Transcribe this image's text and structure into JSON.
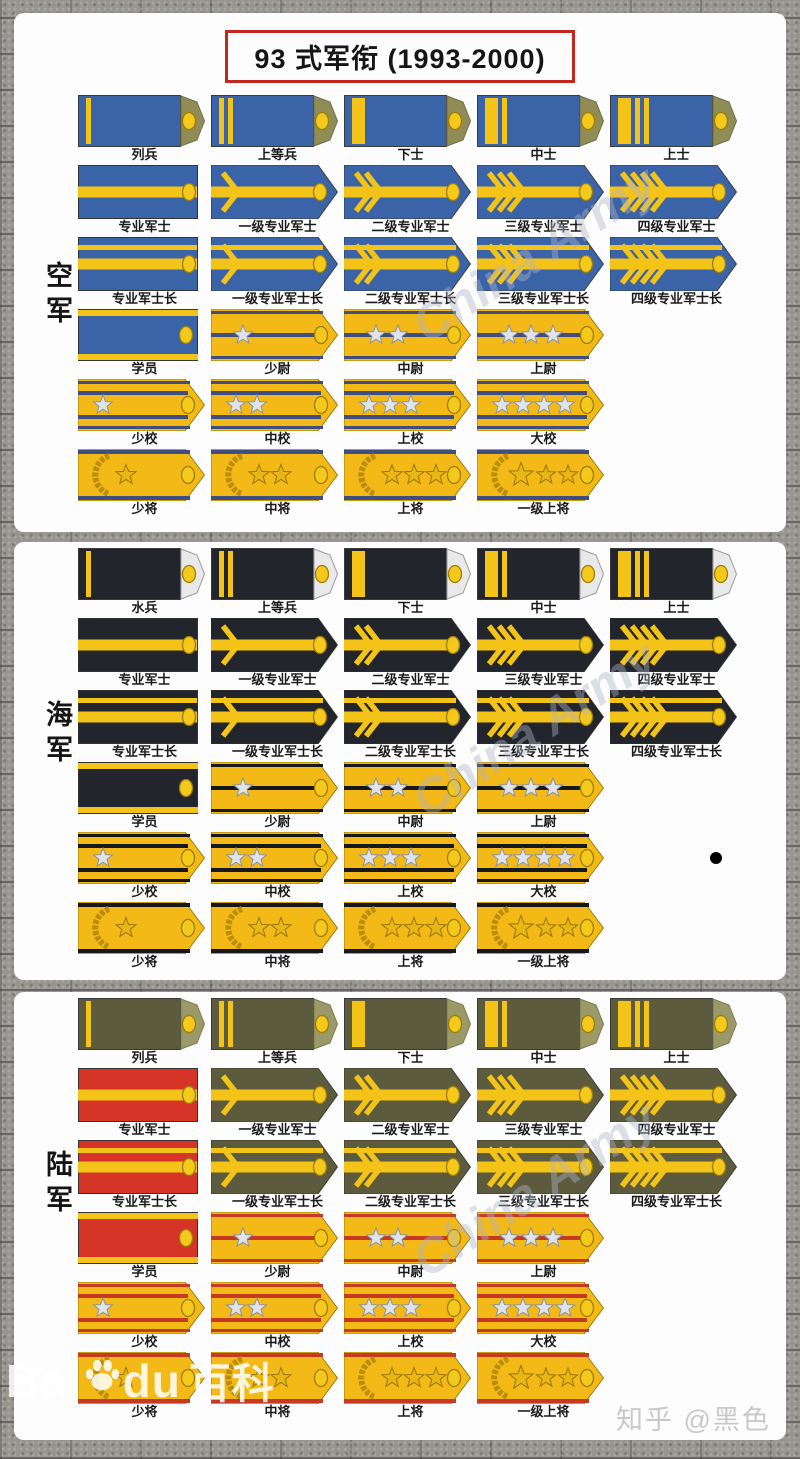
{
  "title": "93 式军衔 (1993-2000)",
  "watermark": {
    "diagonal": "China Army",
    "baidu_prefix": "Bai",
    "baidu_suffix": "du",
    "baidu_cn": "百科",
    "zhihu": "知乎 @黑色"
  },
  "colors": {
    "gold_board": "#f2b917",
    "gold_stripe": "#f3c318",
    "red_board": "#d63426",
    "silver_star": "#dfe3ea",
    "silver_star_edge": "#8d93a0",
    "general_star": "#e8b714",
    "general_star_edge": "#9a7506",
    "button": "#f4c91c",
    "button_edge": "#9c7d08",
    "wreath": "#bb8d0a",
    "title_border": "#c4271f"
  },
  "sections": [
    {
      "id": "af",
      "label": "空军",
      "scheme": {
        "board": "#3b63a8",
        "tip": "#8f8d55",
        "tip_edge": "#70704a",
        "officer_stripe": "#3f4e7e"
      },
      "rows": [
        {
          "type": "enlisted",
          "items": [
            {
              "label": "列兵",
              "stripes": [
                "thin"
              ]
            },
            {
              "label": "上等兵",
              "stripes": [
                "thin",
                "thin"
              ]
            },
            {
              "label": "下士",
              "stripes": [
                "wide"
              ]
            },
            {
              "label": "中士",
              "stripes": [
                "wide",
                "thin"
              ]
            },
            {
              "label": "上士",
              "stripes": [
                "wide",
                "thin",
                "thin"
              ]
            }
          ]
        },
        {
          "type": "sergeant",
          "bars": 1,
          "items": [
            {
              "label": "专业军士",
              "chevrons": 0,
              "shape": "rect"
            },
            {
              "label": "一级专业军士",
              "chevrons": 1
            },
            {
              "label": "二级专业军士",
              "chevrons": 2
            },
            {
              "label": "三级专业军士",
              "chevrons": 3
            },
            {
              "label": "四级专业军士",
              "chevrons": 4
            }
          ]
        },
        {
          "type": "sergeant",
          "bars": 2,
          "items": [
            {
              "label": "专业军士长",
              "chevrons": 0,
              "shape": "rect"
            },
            {
              "label": "一级专业军士长",
              "chevrons": 1
            },
            {
              "label": "二级专业军士长",
              "chevrons": 2
            },
            {
              "label": "三级专业军士长",
              "chevrons": 3
            },
            {
              "label": "四级专业军士长",
              "chevrons": 4
            }
          ]
        },
        {
          "type": "company",
          "items": [
            {
              "label": "学员",
              "cadet": true
            },
            {
              "label": "少尉",
              "stars": 1
            },
            {
              "label": "中尉",
              "stars": 2
            },
            {
              "label": "上尉",
              "stars": 3
            }
          ]
        },
        {
          "type": "field",
          "items": [
            {
              "label": "少校",
              "stars": 1
            },
            {
              "label": "中校",
              "stars": 2
            },
            {
              "label": "上校",
              "stars": 3
            },
            {
              "label": "大校",
              "stars": 4
            }
          ]
        },
        {
          "type": "general",
          "items": [
            {
              "label": "少将",
              "stars": 1
            },
            {
              "label": "中将",
              "stars": 2
            },
            {
              "label": "上将",
              "stars": 3
            },
            {
              "label": "一级上将",
              "stars": 3,
              "special": true
            }
          ]
        }
      ]
    },
    {
      "id": "navy",
      "label": "海军",
      "scheme": {
        "board": "#22252b",
        "tip": "#e9e9e9",
        "tip_edge": "#9a9a9a",
        "officer_stripe": "#17181c"
      },
      "rows": [
        {
          "type": "enlisted",
          "items": [
            {
              "label": "水兵",
              "stripes": [
                "thin"
              ]
            },
            {
              "label": "上等兵",
              "stripes": [
                "thin",
                "thin"
              ]
            },
            {
              "label": "下士",
              "stripes": [
                "wide"
              ]
            },
            {
              "label": "中士",
              "stripes": [
                "wide",
                "thin"
              ]
            },
            {
              "label": "上士",
              "stripes": [
                "wide",
                "thin",
                "thin"
              ]
            }
          ]
        },
        {
          "type": "sergeant",
          "bars": 1,
          "items": [
            {
              "label": "专业军士",
              "chevrons": 0,
              "shape": "rect"
            },
            {
              "label": "一级专业军士",
              "chevrons": 1
            },
            {
              "label": "二级专业军士",
              "chevrons": 2
            },
            {
              "label": "三级专业军士",
              "chevrons": 3
            },
            {
              "label": "四级专业军士",
              "chevrons": 4
            }
          ]
        },
        {
          "type": "sergeant",
          "bars": 2,
          "items": [
            {
              "label": "专业军士长",
              "chevrons": 0,
              "shape": "rect"
            },
            {
              "label": "一级专业军士长",
              "chevrons": 1
            },
            {
              "label": "二级专业军士长",
              "chevrons": 2
            },
            {
              "label": "三级专业军士长",
              "chevrons": 3
            },
            {
              "label": "四级专业军士长",
              "chevrons": 4
            }
          ]
        },
        {
          "type": "company",
          "items": [
            {
              "label": "学员",
              "cadet": true
            },
            {
              "label": "少尉",
              "stars": 1
            },
            {
              "label": "中尉",
              "stars": 2
            },
            {
              "label": "上尉",
              "stars": 3
            }
          ]
        },
        {
          "type": "field",
          "items": [
            {
              "label": "少校",
              "stars": 1
            },
            {
              "label": "中校",
              "stars": 2
            },
            {
              "label": "上校",
              "stars": 3
            },
            {
              "label": "大校",
              "stars": 4
            }
          ]
        },
        {
          "type": "general",
          "items": [
            {
              "label": "少将",
              "stars": 1
            },
            {
              "label": "中将",
              "stars": 2
            },
            {
              "label": "上将",
              "stars": 3
            },
            {
              "label": "一级上将",
              "stars": 3,
              "special": true
            }
          ]
        }
      ]
    },
    {
      "id": "army",
      "label": "陆军",
      "scheme": {
        "board": "#5c5b3d",
        "tip": "#9a9967",
        "tip_edge": "#7c7b50",
        "officer_stripe": "#c63a24"
      },
      "rows": [
        {
          "type": "enlisted",
          "items": [
            {
              "label": "列兵",
              "stripes": [
                "thin"
              ]
            },
            {
              "label": "上等兵",
              "stripes": [
                "thin",
                "thin"
              ]
            },
            {
              "label": "下士",
              "stripes": [
                "wide"
              ]
            },
            {
              "label": "中士",
              "stripes": [
                "wide",
                "thin"
              ]
            },
            {
              "label": "上士",
              "stripes": [
                "wide",
                "thin",
                "thin"
              ]
            }
          ]
        },
        {
          "type": "sergeant",
          "bars": 1,
          "items": [
            {
              "label": "专业军士",
              "chevrons": 0,
              "shape": "rect",
              "variant": "red"
            },
            {
              "label": "一级专业军士",
              "chevrons": 1
            },
            {
              "label": "二级专业军士",
              "chevrons": 2
            },
            {
              "label": "三级专业军士",
              "chevrons": 3
            },
            {
              "label": "四级专业军士",
              "chevrons": 4
            }
          ]
        },
        {
          "type": "sergeant",
          "bars": 2,
          "items": [
            {
              "label": "专业军士长",
              "chevrons": 0,
              "shape": "rect",
              "variant": "red"
            },
            {
              "label": "一级专业军士长",
              "chevrons": 1
            },
            {
              "label": "二级专业军士长",
              "chevrons": 2
            },
            {
              "label": "三级专业军士长",
              "chevrons": 3
            },
            {
              "label": "四级专业军士长",
              "chevrons": 4
            }
          ]
        },
        {
          "type": "company",
          "items": [
            {
              "label": "学员",
              "cadet": true,
              "variant": "red"
            },
            {
              "label": "少尉",
              "stars": 1
            },
            {
              "label": "中尉",
              "stars": 2
            },
            {
              "label": "上尉",
              "stars": 3
            }
          ]
        },
        {
          "type": "field",
          "items": [
            {
              "label": "少校",
              "stars": 1
            },
            {
              "label": "中校",
              "stars": 2
            },
            {
              "label": "上校",
              "stars": 3
            },
            {
              "label": "大校",
              "stars": 4
            }
          ]
        },
        {
          "type": "general",
          "items": [
            {
              "label": "少将",
              "stars": 1
            },
            {
              "label": "中将",
              "stars": 2
            },
            {
              "label": "上将",
              "stars": 3
            },
            {
              "label": "一级上将",
              "stars": 3,
              "special": true
            }
          ]
        }
      ]
    }
  ]
}
